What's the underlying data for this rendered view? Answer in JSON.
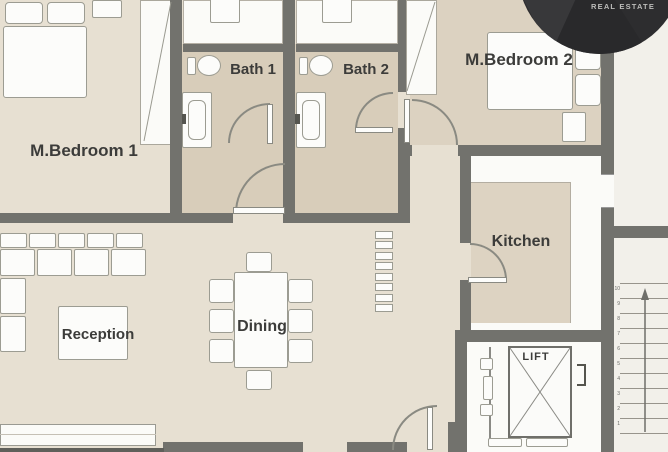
{
  "branding": {
    "logo_text": "REAL ESTATE"
  },
  "rooms": {
    "bedroom1": "M.Bedroom 1",
    "bath1": "Bath 1",
    "bath2": "Bath 2",
    "bedroom2": "M.Bedroom 2",
    "kitchen": "Kitchen",
    "reception": "Reception",
    "dining": "Dining",
    "lift": "LIFT"
  },
  "stairs": {
    "step_labels": [
      "1",
      "2",
      "3",
      "4",
      "5",
      "6",
      "7",
      "8",
      "9",
      "10"
    ]
  },
  "colors": {
    "wall": "#72726d",
    "floor_main": "#e7e0d2",
    "floor_bath": "#d8cdba",
    "floor_kitchen": "#ddd3c2",
    "floor_bedroom2": "#dcd2c1",
    "outside": "#f2f0ea",
    "logo_bg": "#2d2d2f"
  }
}
